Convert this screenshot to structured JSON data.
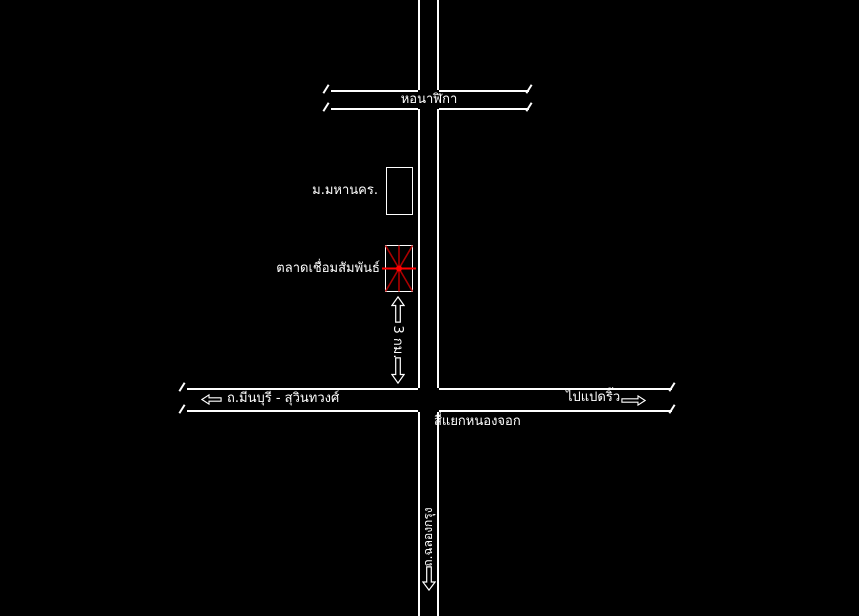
{
  "canvas": {
    "width_px": 859,
    "height_px": 616,
    "background": "#000000",
    "road_line_color": "#ffffff",
    "text_color": "#ffffff"
  },
  "colors": {
    "marker_red_bright": "#ff0000",
    "marker_red_dark": "#aa0000"
  },
  "landmarks": {
    "clock_tower_label": "หอนาฬิกา",
    "university_label": "ม.มหานคร.",
    "market_label": "ตลาดเชื่อมสัมพันธ์",
    "intersection_label": "สี่แยกหนองจอก"
  },
  "roads": {
    "minburi_suwinthawong_label": "ถ.มีนบุรี - สุวินทวงศ์",
    "to_paetriu_label": "ไปแปดริ้ว",
    "chalong_krung_label": "ถ.ฉลองกรุง"
  },
  "annotations": {
    "distance_label": "3 กม."
  },
  "icon_map": {
    "arrow-left-icon": "⇦",
    "arrow-right-icon": "⇨",
    "arrow-up-icon": "⇧",
    "arrow-down-icon": "⇩",
    "star-marker-icon": "✳"
  }
}
